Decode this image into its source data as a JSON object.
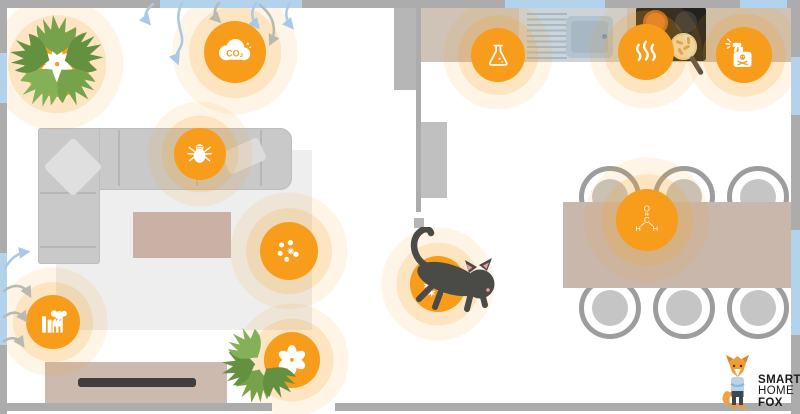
{
  "scene": {
    "description": "Floor plan illustration of indoor air pollution sources in a home",
    "rooms": [
      "living-room",
      "kitchen-dining"
    ]
  },
  "hotspot_labels": {
    "co2": "CO₂"
  },
  "molecule": {
    "oxygen": "O",
    "carbon": "C",
    "hydrogen_left": "H",
    "hydrogen_right": "H"
  },
  "logo": {
    "line1": "SMART",
    "line2": "HOME",
    "line3": "FOX"
  },
  "pollutant_sources": [
    {
      "name": "pollen-houseplant-top",
      "icon": "flower-icon",
      "room": "living-room"
    },
    {
      "name": "co2",
      "icon": "co2-cloud-icon",
      "room": "living-room"
    },
    {
      "name": "dust-mites",
      "icon": "dust-mite-icon",
      "room": "living-room",
      "location": "sofa"
    },
    {
      "name": "fine-particles",
      "icon": "particles-icon",
      "room": "living-room"
    },
    {
      "name": "outdoor-pollution",
      "icon": "factory-icon",
      "room": "living-room",
      "location": "window"
    },
    {
      "name": "pollen-houseplant-bottom",
      "icon": "flower-icon",
      "room": "living-room"
    },
    {
      "name": "chemical-vocs",
      "icon": "flask-icon",
      "room": "kitchen"
    },
    {
      "name": "cooking-fumes",
      "icon": "steam-icon",
      "room": "kitchen",
      "location": "stove"
    },
    {
      "name": "cleaning-products",
      "icon": "spray-bottle-icon",
      "room": "kitchen"
    },
    {
      "name": "formaldehyde",
      "icon": "formaldehyde-molecule-icon",
      "room": "dining",
      "location": "table"
    },
    {
      "name": "pet-dander",
      "icon": "allergen-particles-icon",
      "room": "hallway",
      "location": "cat"
    }
  ],
  "colors": {
    "accent_orange": "#f89c1c",
    "halo_orange": "rgba(246,163,38,0.2)",
    "wall_gray": "#acacac",
    "window_blue": "#b3d2ec",
    "furniture_tan": "#cbb9ad",
    "sofa_gray": "#c9c9c9",
    "cat_gray": "#4a4a47",
    "plant_green": "#76a24c",
    "logo_text": "#1a1a1a"
  }
}
